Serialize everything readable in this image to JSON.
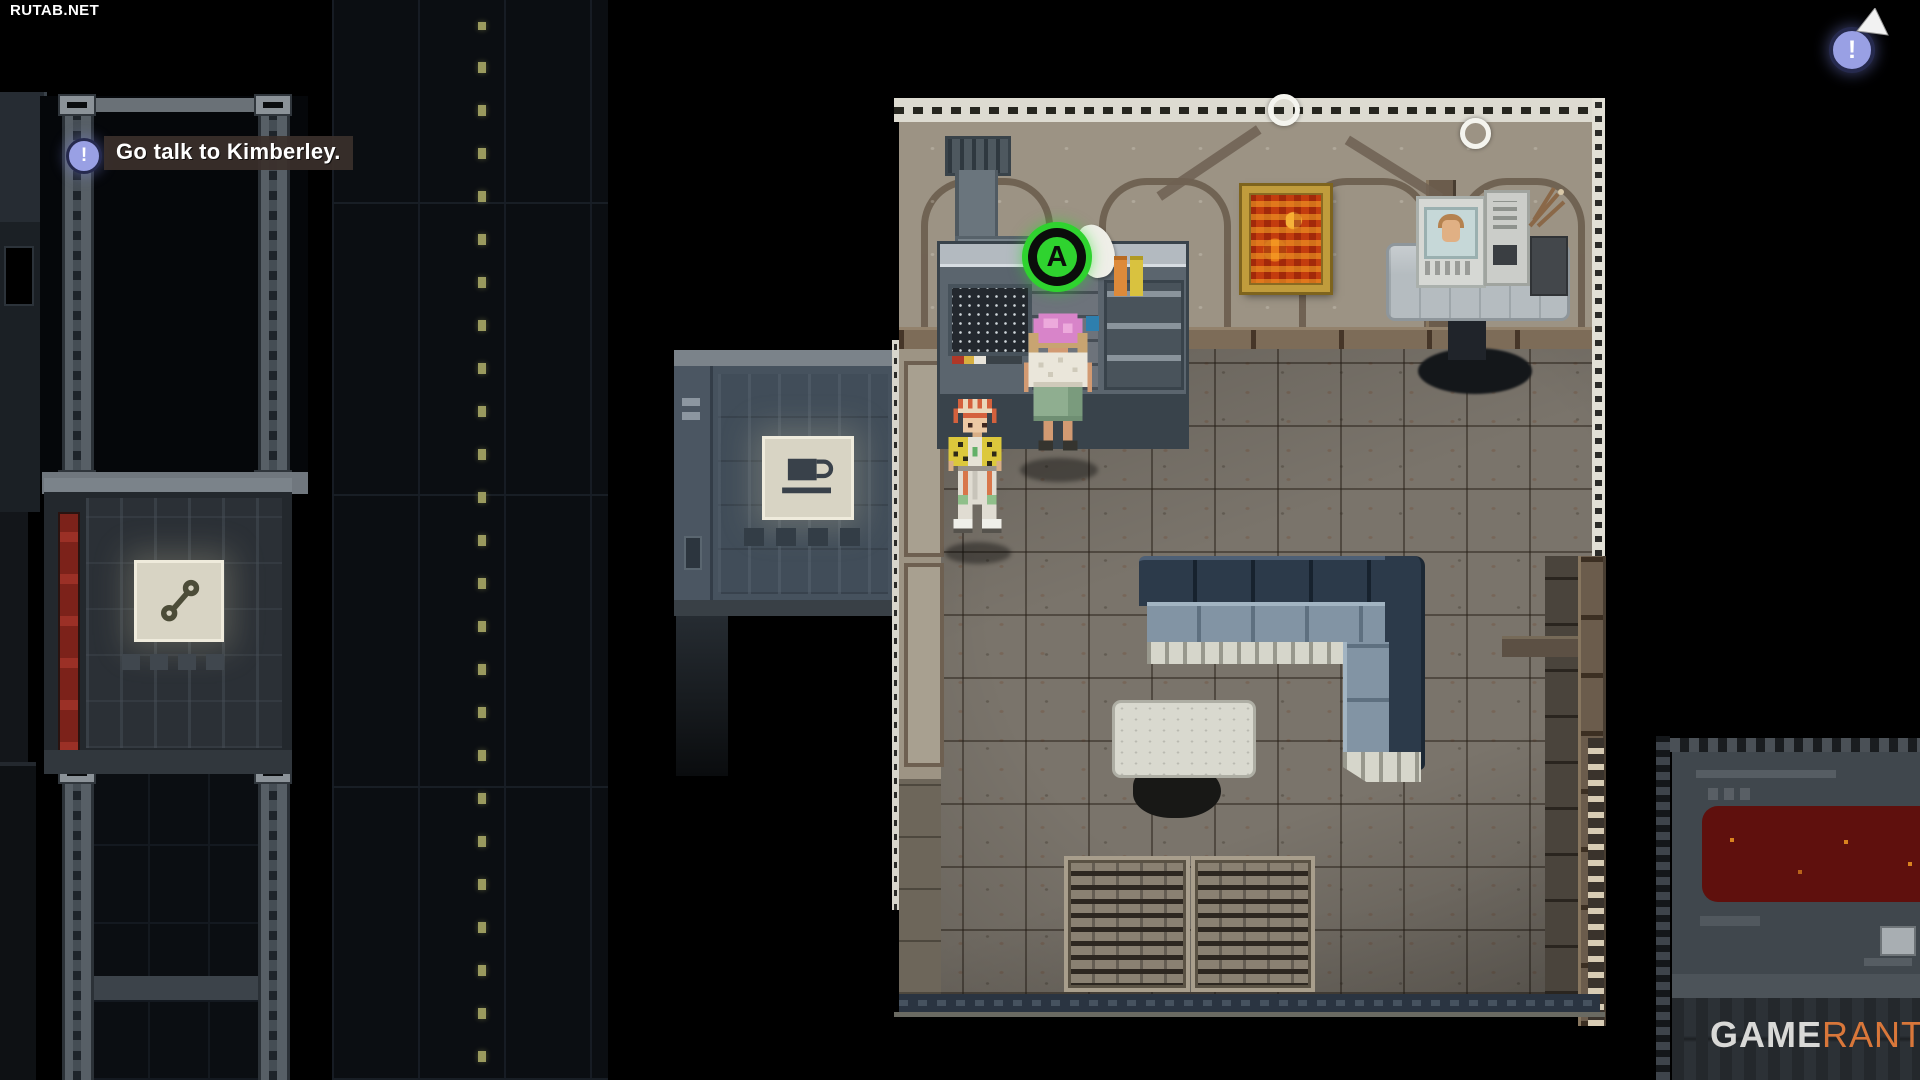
{
  "watermarks": {
    "site": "RUTAB.NET",
    "brand_bold": "GAME",
    "brand_accent": "RANT"
  },
  "hud": {
    "objective": {
      "text": "Go talk to Kimberley.",
      "icon": "exclamation-icon"
    },
    "interact_prompt": {
      "label": "A",
      "ring_color": "#2fd32f"
    },
    "alert_badge": {
      "symbol": "!",
      "fill_color": "#99a0e4"
    }
  },
  "scene": {
    "icons": {
      "vending_left": "wrench-icon",
      "vending_mid": "coffee-cup-icon",
      "pointer": "cursor-arrow-icon"
    },
    "colors": {
      "background": "#000000",
      "room_wall": "#9c9384",
      "room_floor": "#7a746b",
      "room_outline": "#dddbd1",
      "couch_back": "#2c3a4a",
      "couch_cushion": "#8294a4",
      "painting_frame": "#c09c3c",
      "painting_fire": "#c33c0e",
      "road_dash": "#9a9a5e",
      "red_screen": "#5f100d",
      "npc_hair": "#d884c9",
      "player_jacket": "#dcc83c"
    }
  }
}
